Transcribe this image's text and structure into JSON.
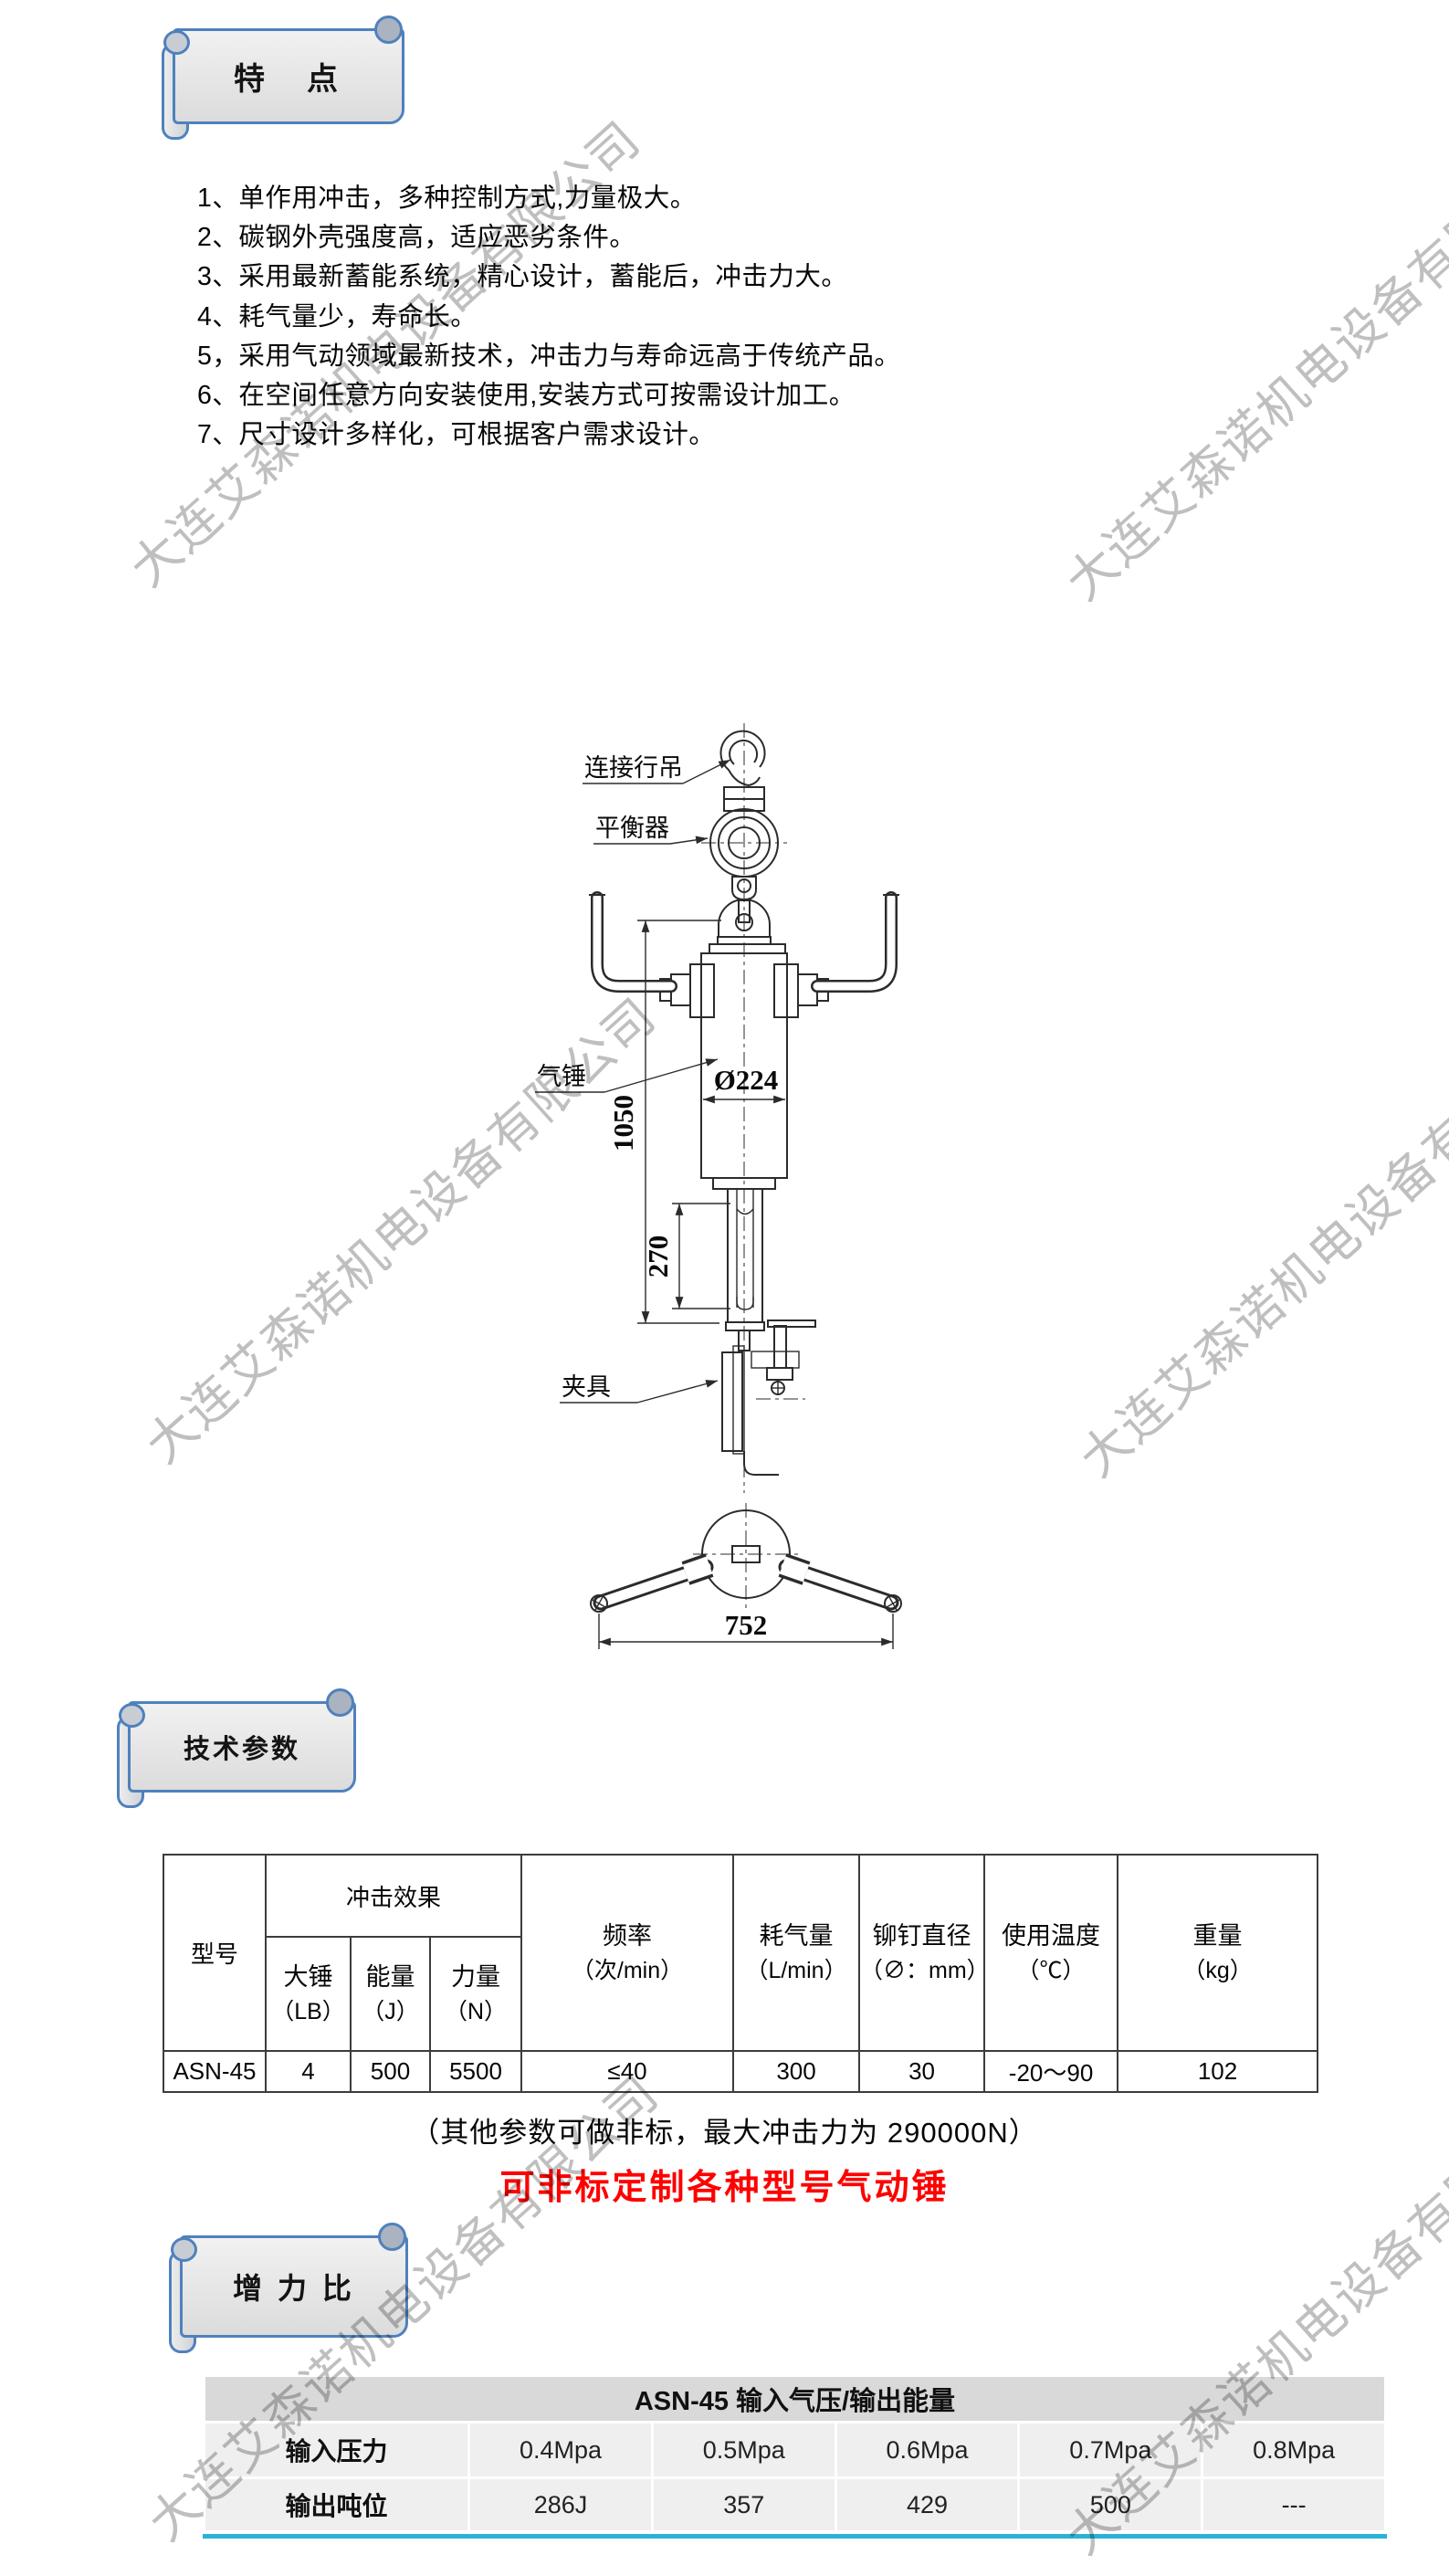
{
  "watermark": {
    "text": "大连艾森诺机电设备有限公司",
    "color": "#bfbfbf"
  },
  "banners": {
    "features": "特　点",
    "tech_params": "技术参数",
    "force_ratio": "增 力 比"
  },
  "features": {
    "items": [
      "1、单作用冲击，多种控制方式,力量极大。",
      "2、碳钢外壳强度高，适应恶劣条件。",
      "3、采用最新蓄能系统，精心设计，蓄能后，冲击力大。",
      "4、耗气量少，寿命长。",
      "5，采用气动领域最新技术，冲击力与寿命远高于传统产品。",
      "6、在空间任意方向安装使用,安装方式可按需设计加工。",
      "7、尺寸设计多样化，可根据客户需求设计。"
    ]
  },
  "diagram": {
    "labels": {
      "hook": "连接行吊",
      "balancer": "平衡器",
      "hammer": "气锤",
      "clamp": "夹具"
    },
    "dims": {
      "total_height": "1050",
      "stroke": "270",
      "diameter": "Ø224",
      "width": "752"
    }
  },
  "spec_table": {
    "model_label": "型号",
    "impact_group_label": "冲击效果",
    "columns": {
      "hammer": {
        "name": "大锤",
        "unit": "（LB）"
      },
      "energy": {
        "name": "能量",
        "unit": "（J）"
      },
      "force": {
        "name": "力量",
        "unit": "（N）"
      },
      "frequency": {
        "name": "频率",
        "unit": "（次/min）"
      },
      "air": {
        "name": "耗气量",
        "unit": "（L/min）"
      },
      "rivet": {
        "name": "铆钉直径",
        "unit": "（∅：mm）"
      },
      "temperature": {
        "name": "使用温度",
        "unit": "（℃）"
      },
      "weight": {
        "name": "重量",
        "unit": "（kg）"
      }
    },
    "row": {
      "model": "ASN-45",
      "hammer": "4",
      "energy": "500",
      "force": "5500",
      "frequency": "≤40",
      "air": "300",
      "rivet": "30",
      "temperature": "-20～90",
      "weight": "102"
    }
  },
  "notes": {
    "non_standard": "（其他参数可做非标，最大冲击力为 290000N）",
    "custom_red": "可非标定制各种型号气动锤",
    "red_color": "#ff0000"
  },
  "energy_table": {
    "title": "ASN-45 输入气压/输出能量",
    "input_label": "输入压力",
    "output_label": "输出吨位",
    "pressures": [
      "0.4Mpa",
      "0.5Mpa",
      "0.6Mpa",
      "0.7Mpa",
      "0.8Mpa"
    ],
    "outputs": [
      "286J",
      "357",
      "429",
      "500",
      "---"
    ]
  }
}
